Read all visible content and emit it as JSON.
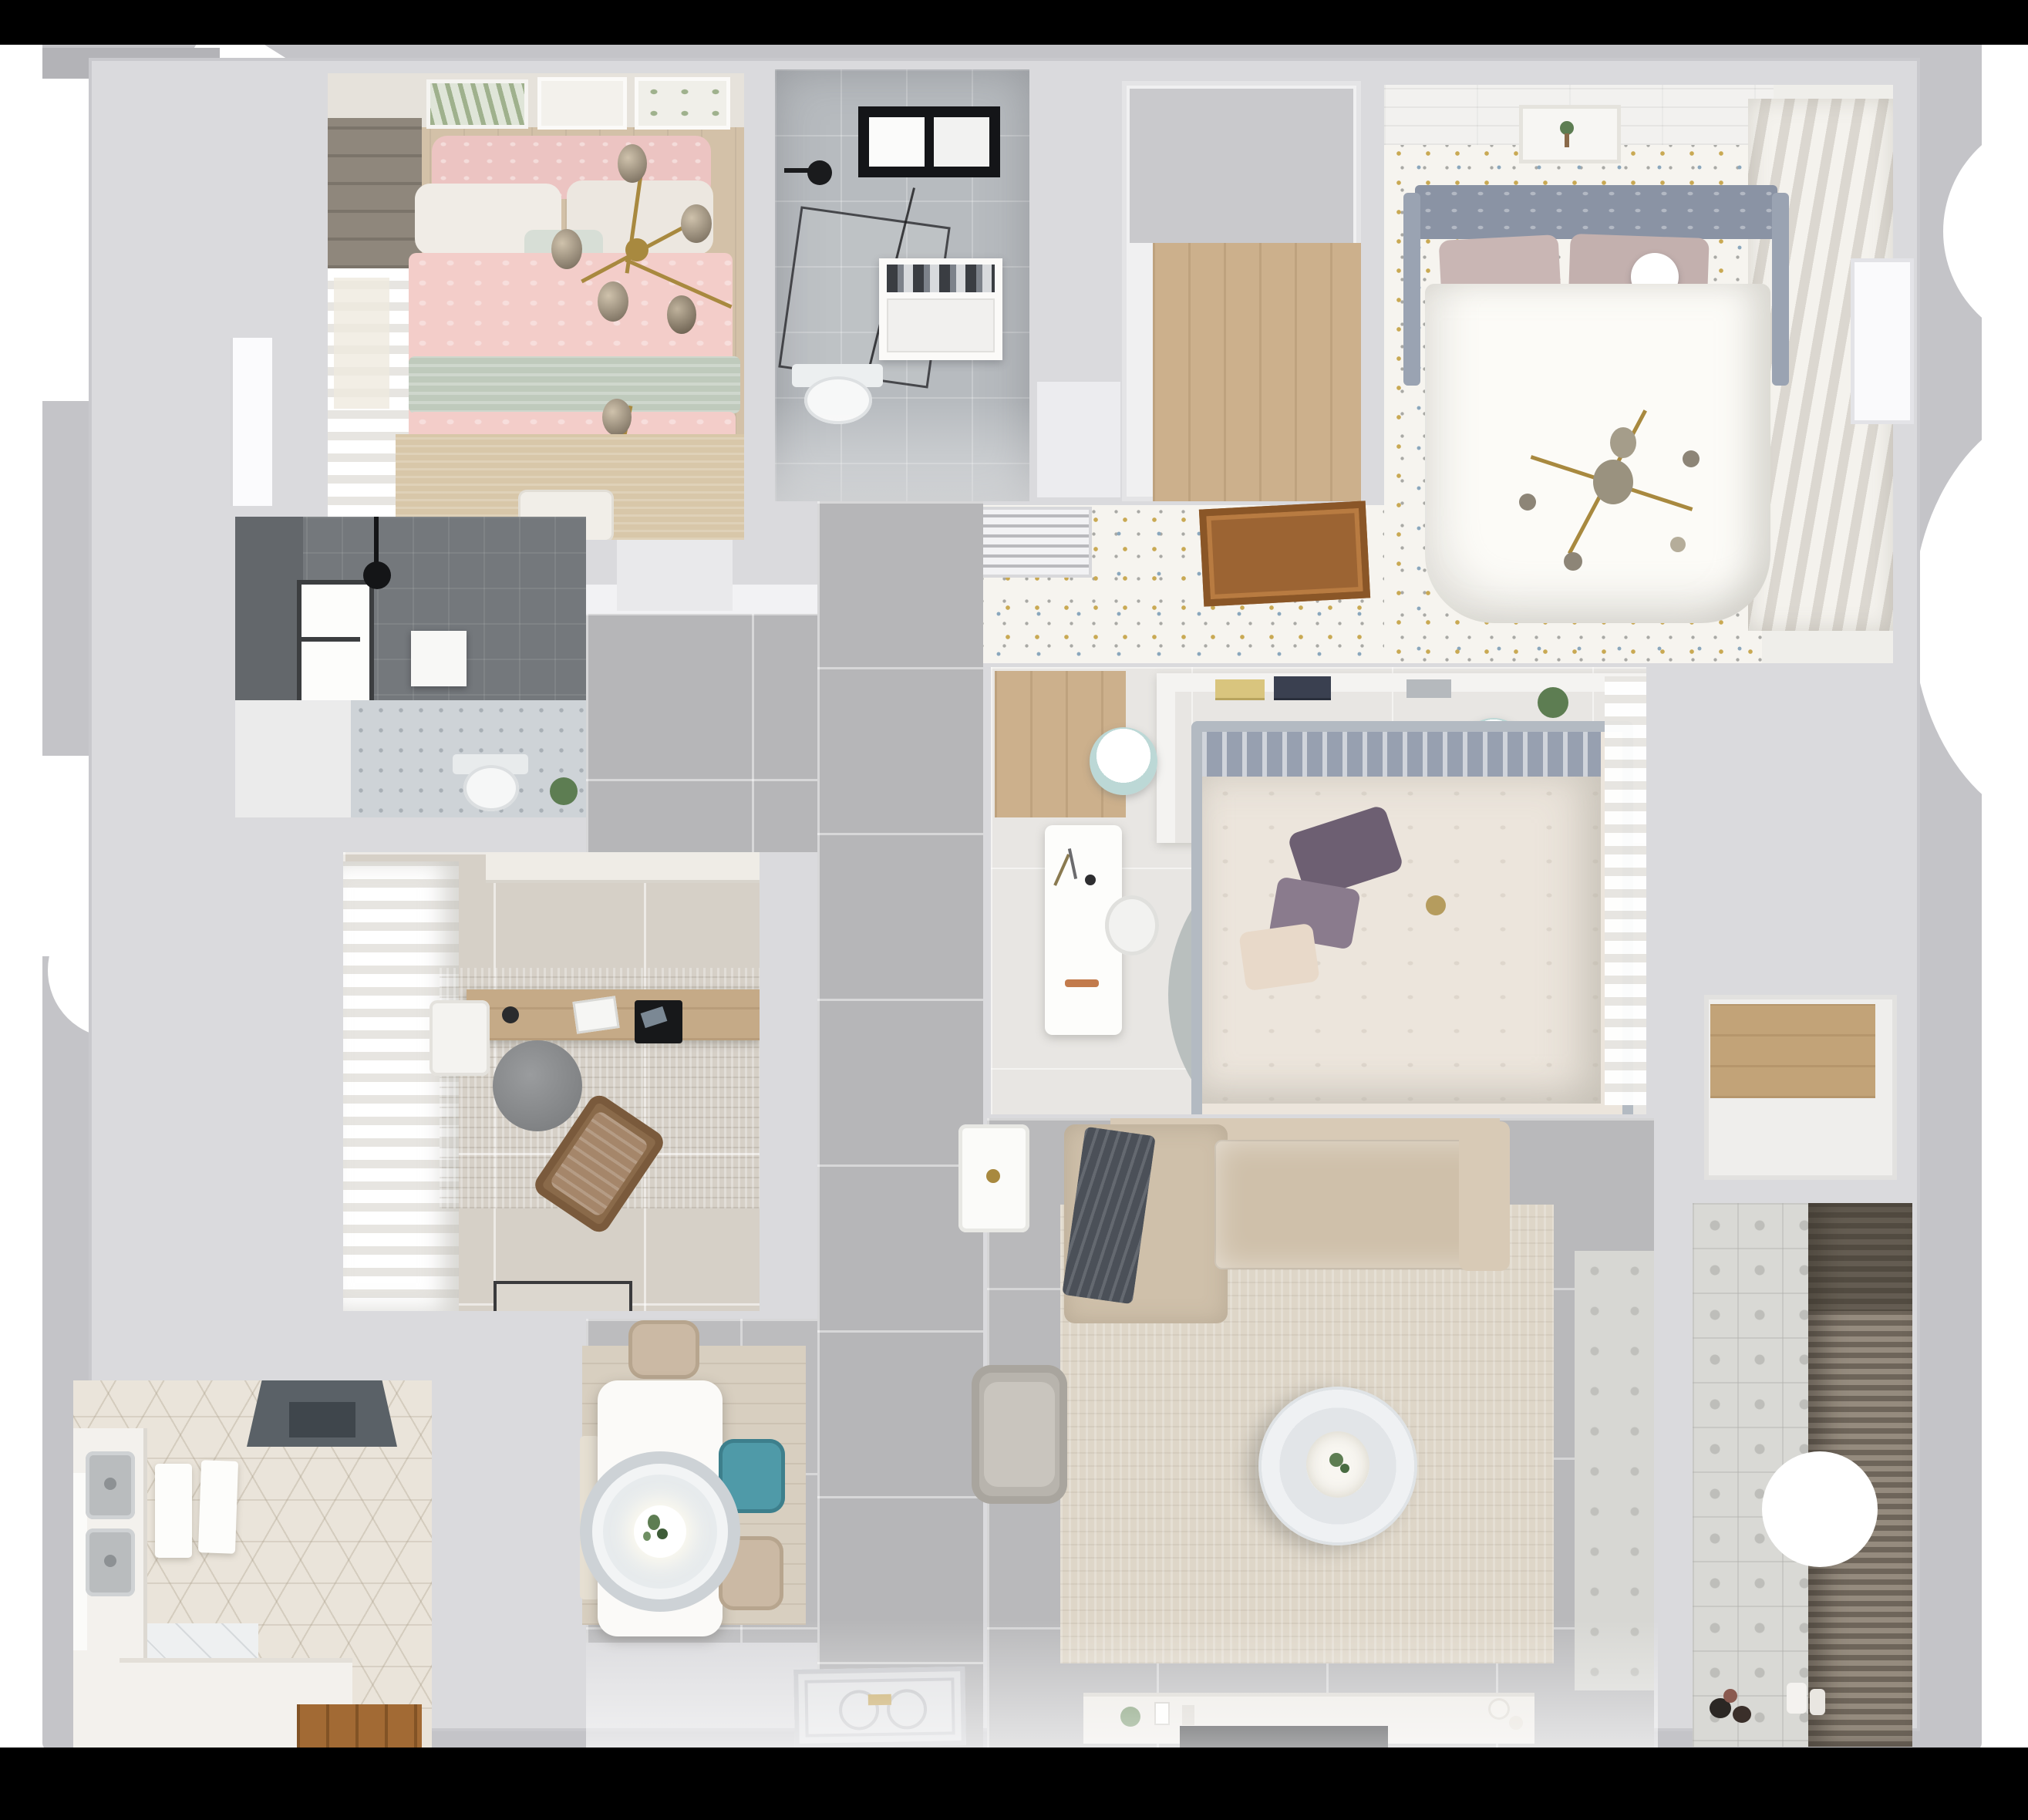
{
  "scene": {
    "type": "3d-floor-plan-top-down-render",
    "description": "Photorealistic top-down 3D render of a furnished apartment floor plan",
    "has_text": false
  },
  "colors": {
    "surround": "#c4c4c8",
    "wall": "#dadadd",
    "black_band": "#000000",
    "hall_tile": "#b6b6b8",
    "study_tile": "#d6d0c7",
    "bath_tile": "#b7bbbf",
    "bath_dark": "#74787c",
    "mosaic": "#ced3d7",
    "hex_tile": "#eae4da",
    "wood_light": "#ccb08c",
    "wood_door": "#a26a34",
    "speckle_base": "#f6f4ef",
    "speckle_gold": "#c9a953",
    "speckle_blue": "#8aa7bd",
    "speckle_gray": "#a9a9a5",
    "pink_duvet": "#f3cdc9",
    "pink_pillow": "#ecc4c2",
    "sage": "#bfcabc",
    "mint": "#d7ded6",
    "white_linen": "#f0ece6",
    "bed_rug": "#d8c7a9",
    "gold": "#a8893f",
    "master_frame": "#8a93a4",
    "master_headboard": "#97a0b0",
    "mauve_pillow": "#c9b6b4",
    "duvet_white": "#fcfbf7",
    "slat_light": "#f4f2ed",
    "slat_dark": "#dbd7d0",
    "center_duvet": "#ece5dc",
    "purple_dark": "#6d5f72",
    "purple_light": "#8a7b8d",
    "cream_pillow": "#e8d9c9",
    "teal_stool": "#bcd8d6",
    "rug_sage": "#b4bab9",
    "rug_pink": "#c7abab",
    "rug_blue": "#7fa7d5",
    "rug_mauve": "#8d7b8c",
    "sofa": "#cfc0aa",
    "sofa_light": "#d8cab6",
    "living_rug": "#ded6c8",
    "throw_dark": "#4b5058",
    "armchair": "#b8b4ad",
    "console": "#ece9e4",
    "tv_black": "#1b1d20",
    "counter_white": "#f3f1ed",
    "steel": "#b9bcbe",
    "hood": "#5a6167",
    "dining_rug": "#d8cfc0",
    "table_white": "#fbfaf8",
    "teal_chair": "#4f9aa8",
    "beige_chair": "#cbb9a4",
    "pendant_ring": "#cdd2d6",
    "balcony_tile": "#d9d9d5",
    "blinds_dark": "#6e655a",
    "blinds_light": "#958b7e",
    "plant_green": "#5d7d52"
  },
  "rooms": [
    {
      "id": "bedroom-pink",
      "label": "Bedroom with pink bedding",
      "furniture": [
        "double-bed",
        "pink-patterned-duvet",
        "white-pillows",
        "mint-cushion",
        "sage-throw",
        "gold-branch-chandelier",
        "three-wall-art-frames",
        "roman-blind-window",
        "sheer-curtains",
        "nightstand-with-lamp",
        "beige-rug"
      ]
    },
    {
      "id": "bathroom-main",
      "label": "Bathroom with walk-in shower",
      "furniture": [
        "black-framed-skylight",
        "ceiling-shower-head",
        "glass-shower-screen",
        "white-vanity",
        "wall-hung-toilet"
      ]
    },
    {
      "id": "cloakroom",
      "label": "Cloakroom corridor with wood floor",
      "furniture": [
        "wood-floor"
      ]
    },
    {
      "id": "master-bedroom",
      "label": "Master bedroom",
      "furniture": [
        "upholstered-gray-headboard",
        "tufted-bed-frame",
        "mauve-pillows",
        "white-ball-lamp",
        "white-duvet",
        "gold-sputnik-chandelier",
        "botanical-art-frame",
        "plank-ceiling-strip",
        "slatted-wardrobe-shutters",
        "confetti-speckled-floor"
      ]
    },
    {
      "id": "corridor",
      "label": "Corridor with speckled floor",
      "furniture": [
        "ac-vent-grille",
        "wooden-ceiling-hatch"
      ]
    },
    {
      "id": "bedroom-center",
      "label": "Second bedroom",
      "furniture": [
        "headboard-shelf-with-books",
        "potted-plant",
        "double-bed",
        "purple-pillows",
        "cream-pillow",
        "layered-round-rug",
        "white-desk",
        "desk-chair",
        "two-teal-poufs",
        "wood-wardrobe-strip",
        "sheer-curtain"
      ]
    },
    {
      "id": "hallway",
      "label": "Hallway with gray tile floor",
      "furniture": [
        "large-gray-floor-tiles",
        "entry-door-mat"
      ]
    },
    {
      "id": "bathroom-second",
      "label": "Second bathroom",
      "furniture": [
        "dark-gray-wall-tiles",
        "window",
        "ceiling-shower-head",
        "towel-panel",
        "toilet",
        "mosaic-floor",
        "plant"
      ]
    },
    {
      "id": "study",
      "label": "Study / home office",
      "furniture": [
        "white-wall-shelf",
        "ruffled-curtains",
        "wood-desk",
        "white-desk-chair",
        "monitor",
        "laptop",
        "round-gray-chair",
        "brown-lounge-chair",
        "distressed-rug",
        "dark-door-mat"
      ]
    },
    {
      "id": "kitchen",
      "label": "Kitchen",
      "furniture": [
        "range-hood",
        "double-stainless-sink",
        "white-counters",
        "cutting-boards",
        "hexagon-tile-floor",
        "window",
        "wooden-door"
      ]
    },
    {
      "id": "dining",
      "label": "Dining area",
      "furniture": [
        "white-dining-table",
        "round-pendant-lamp-with-plant",
        "teal-chair",
        "two-beige-chairs",
        "bench",
        "wood-look-rug"
      ]
    },
    {
      "id": "living-room",
      "label": "Living room",
      "furniture": [
        "l-shaped-beige-sofa",
        "dark-throw-blanket",
        "large-beige-rug",
        "round-white-coffee-table",
        "gray-armchair",
        "white-side-table",
        "tv-console",
        "flat-tv",
        "balcony-threshold-tiles"
      ]
    },
    {
      "id": "storage",
      "label": "Storage room",
      "furniture": [
        "wood-shelf-strip"
      ]
    },
    {
      "id": "balcony",
      "label": "Balcony / laundry",
      "furniture": [
        "patterned-cement-tiles",
        "dark-venetian-blinds",
        "small-objects-on-floor"
      ]
    },
    {
      "id": "entry",
      "label": "Entry",
      "furniture": [
        "ornate-door-mat"
      ]
    }
  ],
  "artifacts": [
    "black-top-band",
    "black-bottom-band",
    "white-corner-notch-top-left",
    "white-circle-bite-right-edge",
    "white-circle-bottom-left",
    "right-edge-white-door"
  ]
}
